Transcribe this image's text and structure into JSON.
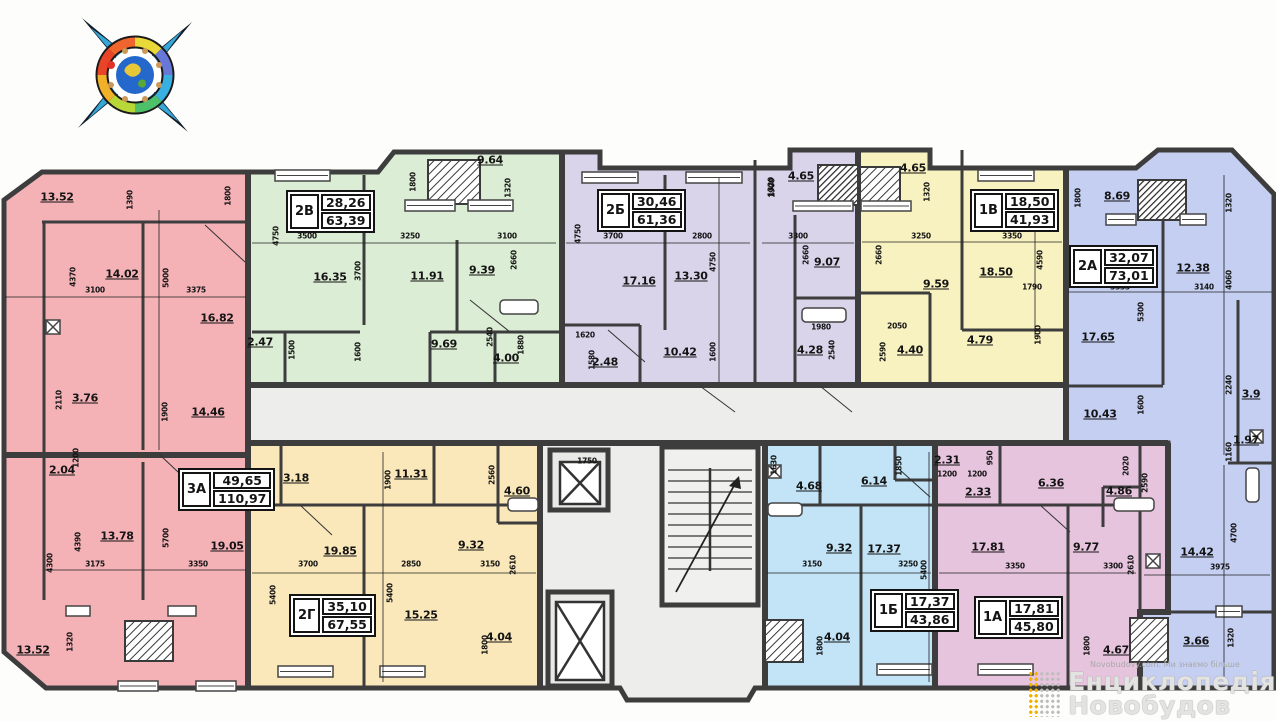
{
  "core": {
    "color": "#ededeb",
    "elevator_label": "1750"
  },
  "watermark": {
    "site": "Novobudovy.com. Ми знаємо більше",
    "line1": "Енциклопедія",
    "line2": "Новобудов"
  },
  "apartments": [
    {
      "code": "3А",
      "living": "49,65",
      "total": "110,97",
      "color": "#f4b2b7",
      "box": {
        "x": 178,
        "y": 468
      }
    },
    {
      "code": "2В",
      "living": "28,26",
      "total": "63,39",
      "color": "#dcedd5",
      "box": {
        "x": 286,
        "y": 190
      }
    },
    {
      "code": "2Б",
      "living": "30,46",
      "total": "61,36",
      "color": "#d9d4ea",
      "box": {
        "x": 597,
        "y": 189
      }
    },
    {
      "code": "1В",
      "living": "18,50",
      "total": "41,93",
      "color": "#f8f2c0",
      "box": {
        "x": 970,
        "y": 189
      }
    },
    {
      "code": "2А",
      "living": "32,07",
      "total": "73,01",
      "color": "#c5cff2",
      "box": {
        "x": 1069,
        "y": 245
      }
    },
    {
      "code": "2Г",
      "living": "35,10",
      "total": "67,55",
      "color": "#fae8ba",
      "box": {
        "x": 289,
        "y": 594
      }
    },
    {
      "code": "1Б",
      "living": "17,37",
      "total": "43,86",
      "color": "#c2e4f6",
      "box": {
        "x": 870,
        "y": 589
      }
    },
    {
      "code": "1А",
      "living": "17,81",
      "total": "45,80",
      "color": "#e7c4de",
      "box": {
        "x": 974,
        "y": 596
      }
    }
  ],
  "area_labels": [
    {
      "t": "13.52",
      "x": 57,
      "y": 197
    },
    {
      "t": "14.02",
      "x": 122,
      "y": 274
    },
    {
      "t": "16.82",
      "x": 217,
      "y": 318
    },
    {
      "t": "3.76",
      "x": 85,
      "y": 398
    },
    {
      "t": "14.46",
      "x": 208,
      "y": 412
    },
    {
      "t": "2.04",
      "x": 62,
      "y": 470
    },
    {
      "t": "13.78",
      "x": 117,
      "y": 536
    },
    {
      "t": "19.05",
      "x": 227,
      "y": 546
    },
    {
      "t": "13.52",
      "x": 33,
      "y": 650
    },
    {
      "t": "9.64",
      "x": 490,
      "y": 160
    },
    {
      "t": "16.35",
      "x": 330,
      "y": 277
    },
    {
      "t": "11.91",
      "x": 427,
      "y": 276
    },
    {
      "t": "9.39",
      "x": 482,
      "y": 270
    },
    {
      "t": "2.47",
      "x": 260,
      "y": 342
    },
    {
      "t": "9.69",
      "x": 444,
      "y": 344
    },
    {
      "t": "4.00",
      "x": 506,
      "y": 358
    },
    {
      "t": "17.16",
      "x": 639,
      "y": 281
    },
    {
      "t": "13.30",
      "x": 691,
      "y": 276
    },
    {
      "t": "10.42",
      "x": 680,
      "y": 352
    },
    {
      "t": "2.48",
      "x": 605,
      "y": 362
    },
    {
      "t": "4.65",
      "x": 801,
      "y": 176
    },
    {
      "t": "9.07",
      "x": 827,
      "y": 262
    },
    {
      "t": "4.28",
      "x": 810,
      "y": 350
    },
    {
      "t": "4.65",
      "x": 913,
      "y": 168
    },
    {
      "t": "9.59",
      "x": 936,
      "y": 284
    },
    {
      "t": "4.40",
      "x": 910,
      "y": 350
    },
    {
      "t": "18.50",
      "x": 996,
      "y": 272
    },
    {
      "t": "4.79",
      "x": 980,
      "y": 340
    },
    {
      "t": "8.69",
      "x": 1117,
      "y": 196
    },
    {
      "t": "12.38",
      "x": 1193,
      "y": 268
    },
    {
      "t": "17.65",
      "x": 1098,
      "y": 337
    },
    {
      "t": "10.43",
      "x": 1100,
      "y": 414
    },
    {
      "t": "3.9",
      "x": 1251,
      "y": 394
    },
    {
      "t": "1.97",
      "x": 1246,
      "y": 440
    },
    {
      "t": "14.42",
      "x": 1197,
      "y": 552
    },
    {
      "t": "3.66",
      "x": 1196,
      "y": 641
    },
    {
      "t": "3.18",
      "x": 296,
      "y": 478
    },
    {
      "t": "11.31",
      "x": 411,
      "y": 474
    },
    {
      "t": "4.60",
      "x": 517,
      "y": 491
    },
    {
      "t": "19.85",
      "x": 340,
      "y": 551
    },
    {
      "t": "9.32",
      "x": 471,
      "y": 545
    },
    {
      "t": "15.25",
      "x": 421,
      "y": 615
    },
    {
      "t": "4.04",
      "x": 499,
      "y": 637
    },
    {
      "t": "4.68",
      "x": 809,
      "y": 486
    },
    {
      "t": "6.14",
      "x": 874,
      "y": 481
    },
    {
      "t": "2.31",
      "x": 947,
      "y": 460
    },
    {
      "t": "9.32",
      "x": 839,
      "y": 548
    },
    {
      "t": "17.37",
      "x": 884,
      "y": 549
    },
    {
      "t": "4.04",
      "x": 837,
      "y": 637
    },
    {
      "t": "2.33",
      "x": 978,
      "y": 492
    },
    {
      "t": "6.36",
      "x": 1051,
      "y": 483
    },
    {
      "t": "4.86",
      "x": 1119,
      "y": 491
    },
    {
      "t": "17.81",
      "x": 988,
      "y": 547
    },
    {
      "t": "9.77",
      "x": 1086,
      "y": 547
    },
    {
      "t": "4.67",
      "x": 1116,
      "y": 650
    }
  ],
  "dim_labels": [
    {
      "t": "1390",
      "x": 130,
      "y": 200,
      "r": 90
    },
    {
      "t": "1800",
      "x": 228,
      "y": 196,
      "r": 90
    },
    {
      "t": "4370",
      "x": 73,
      "y": 277,
      "r": 90
    },
    {
      "t": "5000",
      "x": 166,
      "y": 278,
      "r": 90
    },
    {
      "t": "3100",
      "x": 95,
      "y": 290,
      "r": 0
    },
    {
      "t": "3375",
      "x": 196,
      "y": 290,
      "r": 0
    },
    {
      "t": "2110",
      "x": 59,
      "y": 400,
      "r": 90
    },
    {
      "t": "1900",
      "x": 165,
      "y": 412,
      "r": 90
    },
    {
      "t": "1200",
      "x": 76,
      "y": 458,
      "r": 90
    },
    {
      "t": "4390",
      "x": 78,
      "y": 542,
      "r": 90
    },
    {
      "t": "5700",
      "x": 166,
      "y": 538,
      "r": 90
    },
    {
      "t": "3175",
      "x": 95,
      "y": 564,
      "r": 0
    },
    {
      "t": "3350",
      "x": 198,
      "y": 564,
      "r": 0
    },
    {
      "t": "1320",
      "x": 70,
      "y": 642,
      "r": 90
    },
    {
      "t": "4300",
      "x": 50,
      "y": 563,
      "r": 90
    },
    {
      "t": "4750",
      "x": 276,
      "y": 236,
      "r": 90
    },
    {
      "t": "3500",
      "x": 307,
      "y": 236,
      "r": 0
    },
    {
      "t": "3700",
      "x": 358,
      "y": 271,
      "r": 90
    },
    {
      "t": "3250",
      "x": 410,
      "y": 236,
      "r": 0
    },
    {
      "t": "1800",
      "x": 413,
      "y": 182,
      "r": 90
    },
    {
      "t": "1320",
      "x": 508,
      "y": 188,
      "r": 90
    },
    {
      "t": "3100",
      "x": 507,
      "y": 236,
      "r": 0
    },
    {
      "t": "2660",
      "x": 514,
      "y": 260,
      "r": 90
    },
    {
      "t": "1600",
      "x": 358,
      "y": 352,
      "r": 90
    },
    {
      "t": "2540",
      "x": 490,
      "y": 337,
      "r": 90
    },
    {
      "t": "1880",
      "x": 521,
      "y": 345,
      "r": 90
    },
    {
      "t": "1500",
      "x": 292,
      "y": 350,
      "r": 90
    },
    {
      "t": "4750",
      "x": 578,
      "y": 234,
      "r": 90
    },
    {
      "t": "3700",
      "x": 613,
      "y": 236,
      "r": 0
    },
    {
      "t": "2800",
      "x": 702,
      "y": 236,
      "r": 0
    },
    {
      "t": "4750",
      "x": 713,
      "y": 262,
      "r": 90
    },
    {
      "t": "1900",
      "x": 772,
      "y": 188,
      "r": 90
    },
    {
      "t": "1600",
      "x": 713,
      "y": 352,
      "r": 90
    },
    {
      "t": "1620",
      "x": 585,
      "y": 335,
      "r": 0
    },
    {
      "t": "1580",
      "x": 592,
      "y": 360,
      "r": 90
    },
    {
      "t": "1320",
      "x": 771,
      "y": 187,
      "r": 90
    },
    {
      "t": "3300",
      "x": 798,
      "y": 236,
      "r": 0
    },
    {
      "t": "2660",
      "x": 806,
      "y": 255,
      "r": 90
    },
    {
      "t": "1980",
      "x": 821,
      "y": 327,
      "r": 0
    },
    {
      "t": "2540",
      "x": 832,
      "y": 350,
      "r": 90
    },
    {
      "t": "1320",
      "x": 927,
      "y": 192,
      "r": 90
    },
    {
      "t": "3250",
      "x": 921,
      "y": 236,
      "r": 0
    },
    {
      "t": "2660",
      "x": 879,
      "y": 255,
      "r": 90
    },
    {
      "t": "2050",
      "x": 897,
      "y": 326,
      "r": 0
    },
    {
      "t": "2590",
      "x": 883,
      "y": 352,
      "r": 90
    },
    {
      "t": "3350",
      "x": 1012,
      "y": 236,
      "r": 0
    },
    {
      "t": "4590",
      "x": 1040,
      "y": 260,
      "r": 90
    },
    {
      "t": "1790",
      "x": 1032,
      "y": 287,
      "r": 0
    },
    {
      "t": "1900",
      "x": 1038,
      "y": 335,
      "r": 90
    },
    {
      "t": "1800",
      "x": 1078,
      "y": 198,
      "r": 90
    },
    {
      "t": "1320",
      "x": 1229,
      "y": 203,
      "r": 90
    },
    {
      "t": "4060",
      "x": 1229,
      "y": 280,
      "r": 90
    },
    {
      "t": "3335",
      "x": 1120,
      "y": 287,
      "r": 0
    },
    {
      "t": "3140",
      "x": 1204,
      "y": 287,
      "r": 0
    },
    {
      "t": "5300",
      "x": 1141,
      "y": 312,
      "r": 90
    },
    {
      "t": "1600",
      "x": 1141,
      "y": 405,
      "r": 90
    },
    {
      "t": "2240",
      "x": 1229,
      "y": 385,
      "r": 90
    },
    {
      "t": "1160",
      "x": 1229,
      "y": 452,
      "r": 90
    },
    {
      "t": "4700",
      "x": 1234,
      "y": 533,
      "r": 90
    },
    {
      "t": "3975",
      "x": 1220,
      "y": 567,
      "r": 0
    },
    {
      "t": "1320",
      "x": 1231,
      "y": 638,
      "r": 90
    },
    {
      "t": "1900",
      "x": 388,
      "y": 480,
      "r": 90
    },
    {
      "t": "1600",
      "x": 261,
      "y": 480,
      "r": 90
    },
    {
      "t": "2560",
      "x": 492,
      "y": 475,
      "r": 90
    },
    {
      "t": "3700",
      "x": 308,
      "y": 564,
      "r": 0
    },
    {
      "t": "2850",
      "x": 411,
      "y": 564,
      "r": 0
    },
    {
      "t": "3150",
      "x": 490,
      "y": 564,
      "r": 0
    },
    {
      "t": "5400",
      "x": 273,
      "y": 595,
      "r": 90
    },
    {
      "t": "5400",
      "x": 390,
      "y": 593,
      "r": 90
    },
    {
      "t": "2610",
      "x": 513,
      "y": 565,
      "r": 90
    },
    {
      "t": "1800",
      "x": 485,
      "y": 645,
      "r": 90
    },
    {
      "t": "1630",
      "x": 774,
      "y": 465,
      "r": 90
    },
    {
      "t": "1850",
      "x": 899,
      "y": 466,
      "r": 90
    },
    {
      "t": "1200",
      "x": 947,
      "y": 474,
      "r": 0
    },
    {
      "t": "3150",
      "x": 812,
      "y": 564,
      "r": 0
    },
    {
      "t": "3250",
      "x": 908,
      "y": 564,
      "r": 0
    },
    {
      "t": "5400",
      "x": 924,
      "y": 570,
      "r": 90
    },
    {
      "t": "1800",
      "x": 820,
      "y": 646,
      "r": 90
    },
    {
      "t": "1200",
      "x": 977,
      "y": 474,
      "r": 0
    },
    {
      "t": "950",
      "x": 990,
      "y": 458,
      "r": 90
    },
    {
      "t": "2020",
      "x": 1126,
      "y": 466,
      "r": 90
    },
    {
      "t": "2590",
      "x": 1145,
      "y": 483,
      "r": 90
    },
    {
      "t": "3350",
      "x": 1015,
      "y": 566,
      "r": 0
    },
    {
      "t": "3300",
      "x": 1113,
      "y": 566,
      "r": 0
    },
    {
      "t": "2610",
      "x": 1131,
      "y": 565,
      "r": 90
    },
    {
      "t": "1800",
      "x": 1087,
      "y": 646,
      "r": 90
    },
    {
      "t": "1750",
      "x": 587,
      "y": 461,
      "r": 0
    }
  ]
}
